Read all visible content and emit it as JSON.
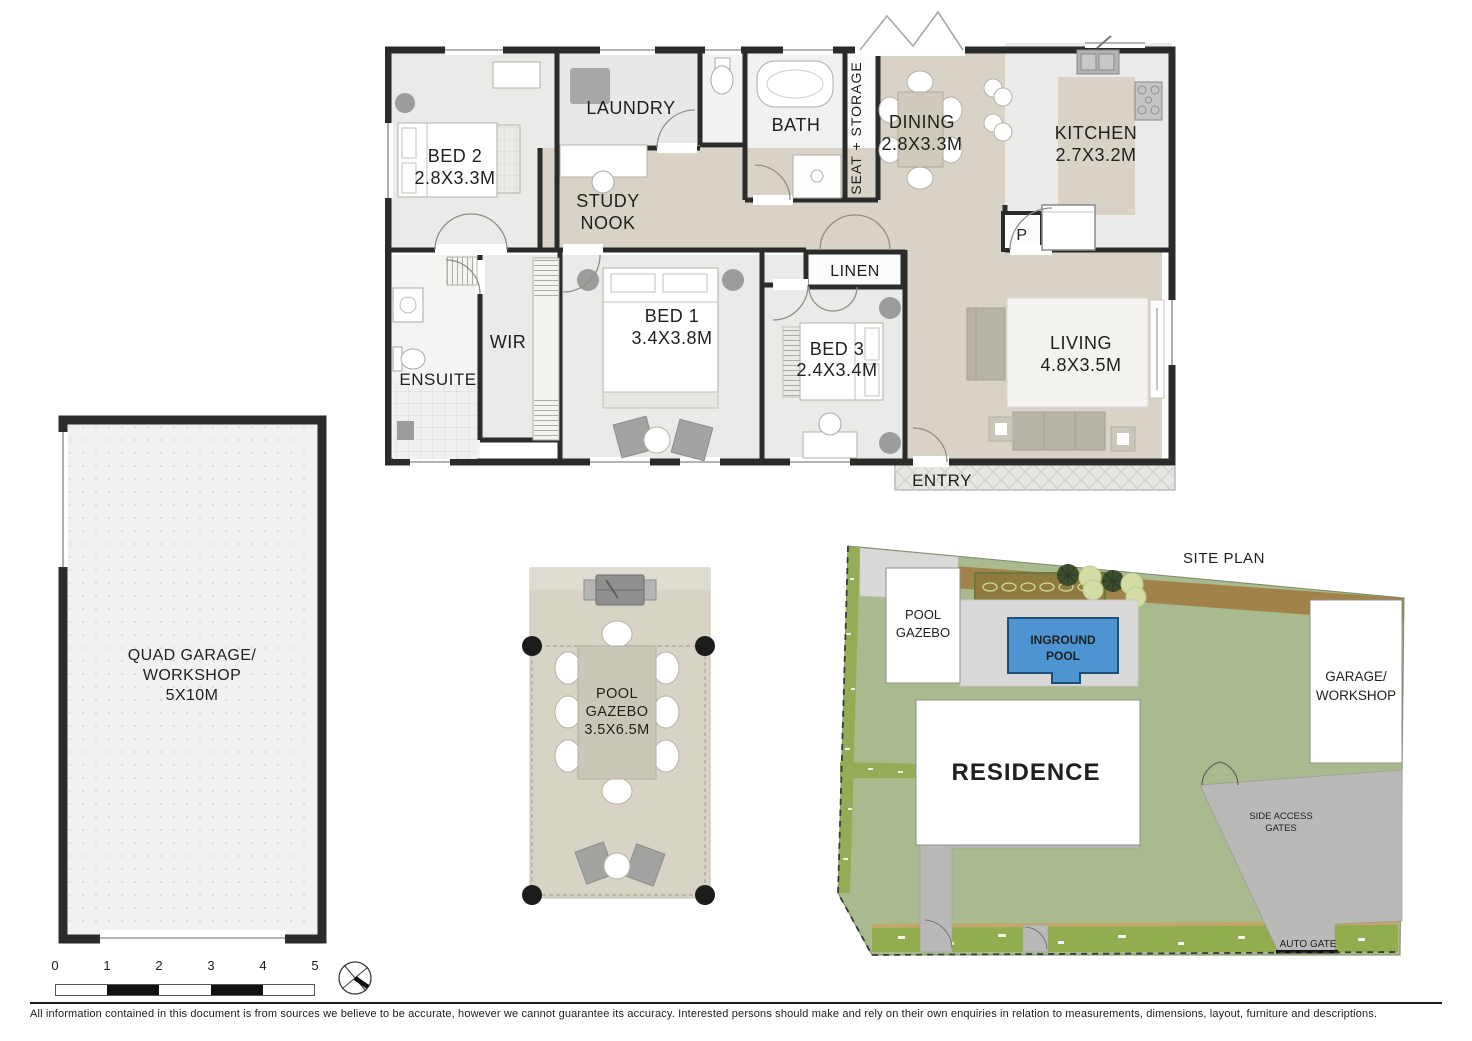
{
  "floor_plan": {
    "rooms": {
      "bed2": {
        "label": "BED 2",
        "dims": "2.8X3.3M"
      },
      "laundry": {
        "label": "LAUNDRY"
      },
      "study_nook": {
        "line1": "STUDY",
        "line2": "NOOK"
      },
      "bath": {
        "label": "BATH"
      },
      "seat_storage": {
        "label": "SEAT + STORAGE"
      },
      "dining": {
        "label": "DINING",
        "dims": "2.8X3.3M"
      },
      "kitchen": {
        "label": "KITCHEN",
        "dims": "2.7X3.2M"
      },
      "pantry": {
        "label": "P"
      },
      "linen": {
        "label": "LINEN"
      },
      "wir": {
        "label": "WIR"
      },
      "ensuite": {
        "label": "ENSUITE"
      },
      "bed1": {
        "label": "BED 1",
        "dims": "3.4X3.8M"
      },
      "bed3": {
        "label": "BED 3",
        "dims": "2.4X3.4M"
      },
      "living": {
        "label": "LIVING",
        "dims": "4.8X3.5M"
      },
      "entry": {
        "label": "ENTRY"
      }
    }
  },
  "garage_plan": {
    "line1": "QUAD GARAGE/",
    "line2": "WORKSHOP",
    "dims": "5X10M"
  },
  "gazebo_plan": {
    "line1": "POOL",
    "line2": "GAZEBO",
    "dims": "3.5X6.5M"
  },
  "site_plan": {
    "title": "SITE PLAN",
    "pool_gazebo": {
      "line1": "POOL",
      "line2": "GAZEBO"
    },
    "inground_pool": {
      "line1": "INGROUND",
      "line2": "POOL"
    },
    "residence": {
      "label": "RESIDENCE"
    },
    "garage_workshop": {
      "line1": "GARAGE/",
      "line2": "WORKSHOP"
    },
    "side_access_gates": {
      "line1": "SIDE ACCESS",
      "line2": "GATES"
    },
    "auto_gate": {
      "label": "AUTO GATE"
    }
  },
  "scale_bar": {
    "ticks": [
      "0",
      "1",
      "2",
      "3",
      "4",
      "5"
    ]
  },
  "disclaimer": "All information contained in this document is from sources we believe to be accurate, however we cannot guarantee its accuracy. Interested persons should make and rely on their own enquiries in relation to measurements, dimensions, layout, furniture and descriptions.",
  "colors": {
    "wall": "#2b2b29",
    "floor_light": "#eaeae9",
    "floor_beige": "#d8d3c6",
    "lawn": "#a9ba8e",
    "hedge": "#93ac55",
    "garden_bed": "#a1824a",
    "pool_blue": "#4d95d2",
    "driveway": "#b9b9b7",
    "pool_paving": "#d9d9d7"
  }
}
